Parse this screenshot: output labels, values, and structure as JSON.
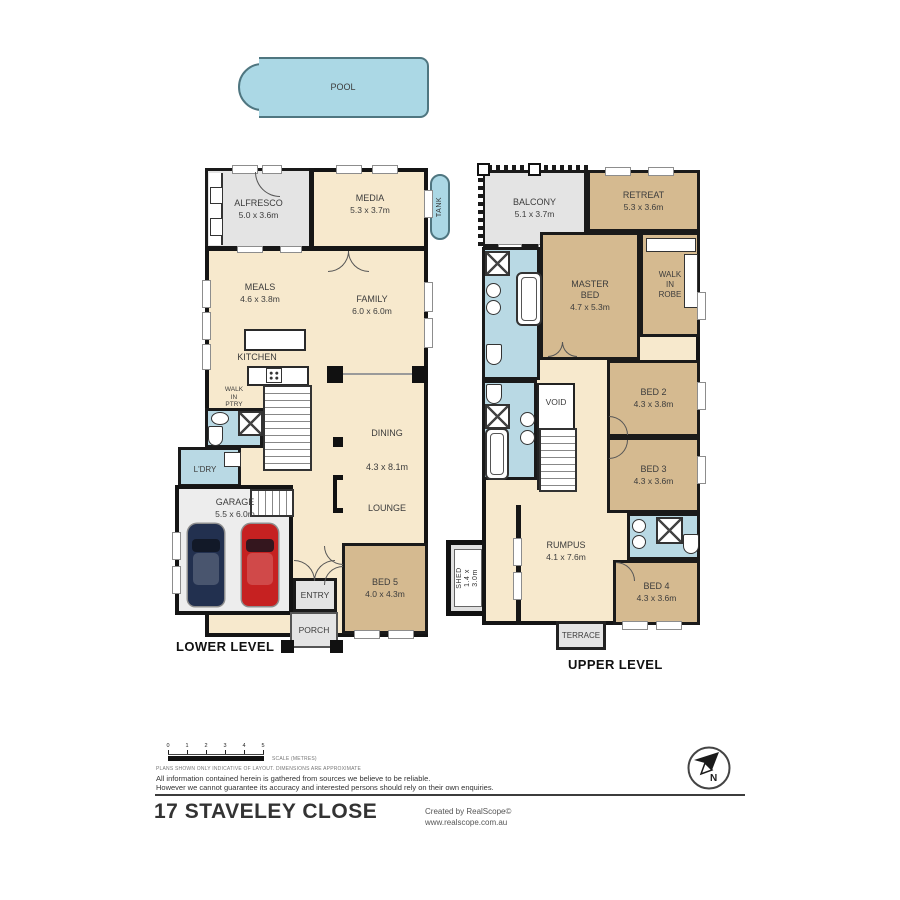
{
  "meta": {
    "address_title": "17 STAVELEY CLOSE"
  },
  "levels": {
    "lower_label": "LOWER LEVEL",
    "upper_label": "UPPER LEVEL"
  },
  "rooms": {
    "pool": {
      "name": "POOL"
    },
    "tank": {
      "name": "TANK"
    },
    "alfresco": {
      "name": "ALFRESCO",
      "dims": "5.0 x 3.6m"
    },
    "media": {
      "name": "MEDIA",
      "dims": "5.3 x 3.7m"
    },
    "meals": {
      "name": "MEALS",
      "dims": "4.6 x 3.8m"
    },
    "family": {
      "name": "FAMILY",
      "dims": "6.0 x 6.0m"
    },
    "kitchen": {
      "name": "KITCHEN"
    },
    "walk_in_ptry": {
      "name": "WALK\nIN\nPTRY"
    },
    "ldry": {
      "name": "L'DRY"
    },
    "dining": {
      "name": "DINING",
      "dims": "4.3 x 8.1m"
    },
    "lounge": {
      "name": "LOUNGE"
    },
    "garage": {
      "name": "GARAGE",
      "dims": "5.5 x 6.0m"
    },
    "entry": {
      "name": "ENTRY"
    },
    "porch": {
      "name": "PORCH"
    },
    "bed5": {
      "name": "BED 5",
      "dims": "4.0 x 4.3m"
    },
    "shed": {
      "name": "SHED\n1.4 x 3.0m"
    },
    "balcony": {
      "name": "BALCONY",
      "dims": "5.1 x 3.7m"
    },
    "retreat": {
      "name": "RETREAT",
      "dims": "5.3 x 3.6m"
    },
    "master_bed": {
      "name": "MASTER\nBED",
      "dims": "4.7 x 5.3m"
    },
    "walk_in_robe": {
      "name": "WALK\nIN\nROBE"
    },
    "void": {
      "name": "VOID"
    },
    "bed2": {
      "name": "BED 2",
      "dims": "4.3 x 3.8m"
    },
    "bed3": {
      "name": "BED 3",
      "dims": "4.3 x 3.6m"
    },
    "rumpus": {
      "name": "RUMPUS",
      "dims": "4.1 x 7.6m"
    },
    "bed4": {
      "name": "BED 4",
      "dims": "4.3 x 3.6m"
    },
    "terrace": {
      "name": "TERRACE"
    }
  },
  "footer": {
    "scale_ticks": [
      "0",
      "1",
      "2",
      "3",
      "4",
      "5"
    ],
    "scale_label": "SCALE (METRES)",
    "fine_print": "PLANS SHOWN ONLY INDICATIVE OF LAYOUT. DIMENSIONS ARE APPROXIMATE",
    "disclaimer_line1": "All information contained herein is gathered from sources we believe to be reliable.",
    "disclaimer_line2": "However we cannot guarantee its accuracy and interested persons should rely on their own enquiries.",
    "credit_line1": "Created by RealScope©",
    "credit_line2": "www.realscope.com.au",
    "north_label": "N"
  },
  "colors": {
    "water": "#abd8e5",
    "wet_area": "#b9d9e4",
    "floor_cream": "#f7e9cd",
    "floor_tan": "#d5ba90",
    "floor_grey": "#e4e4e4",
    "wall": "#1a1a1a"
  }
}
